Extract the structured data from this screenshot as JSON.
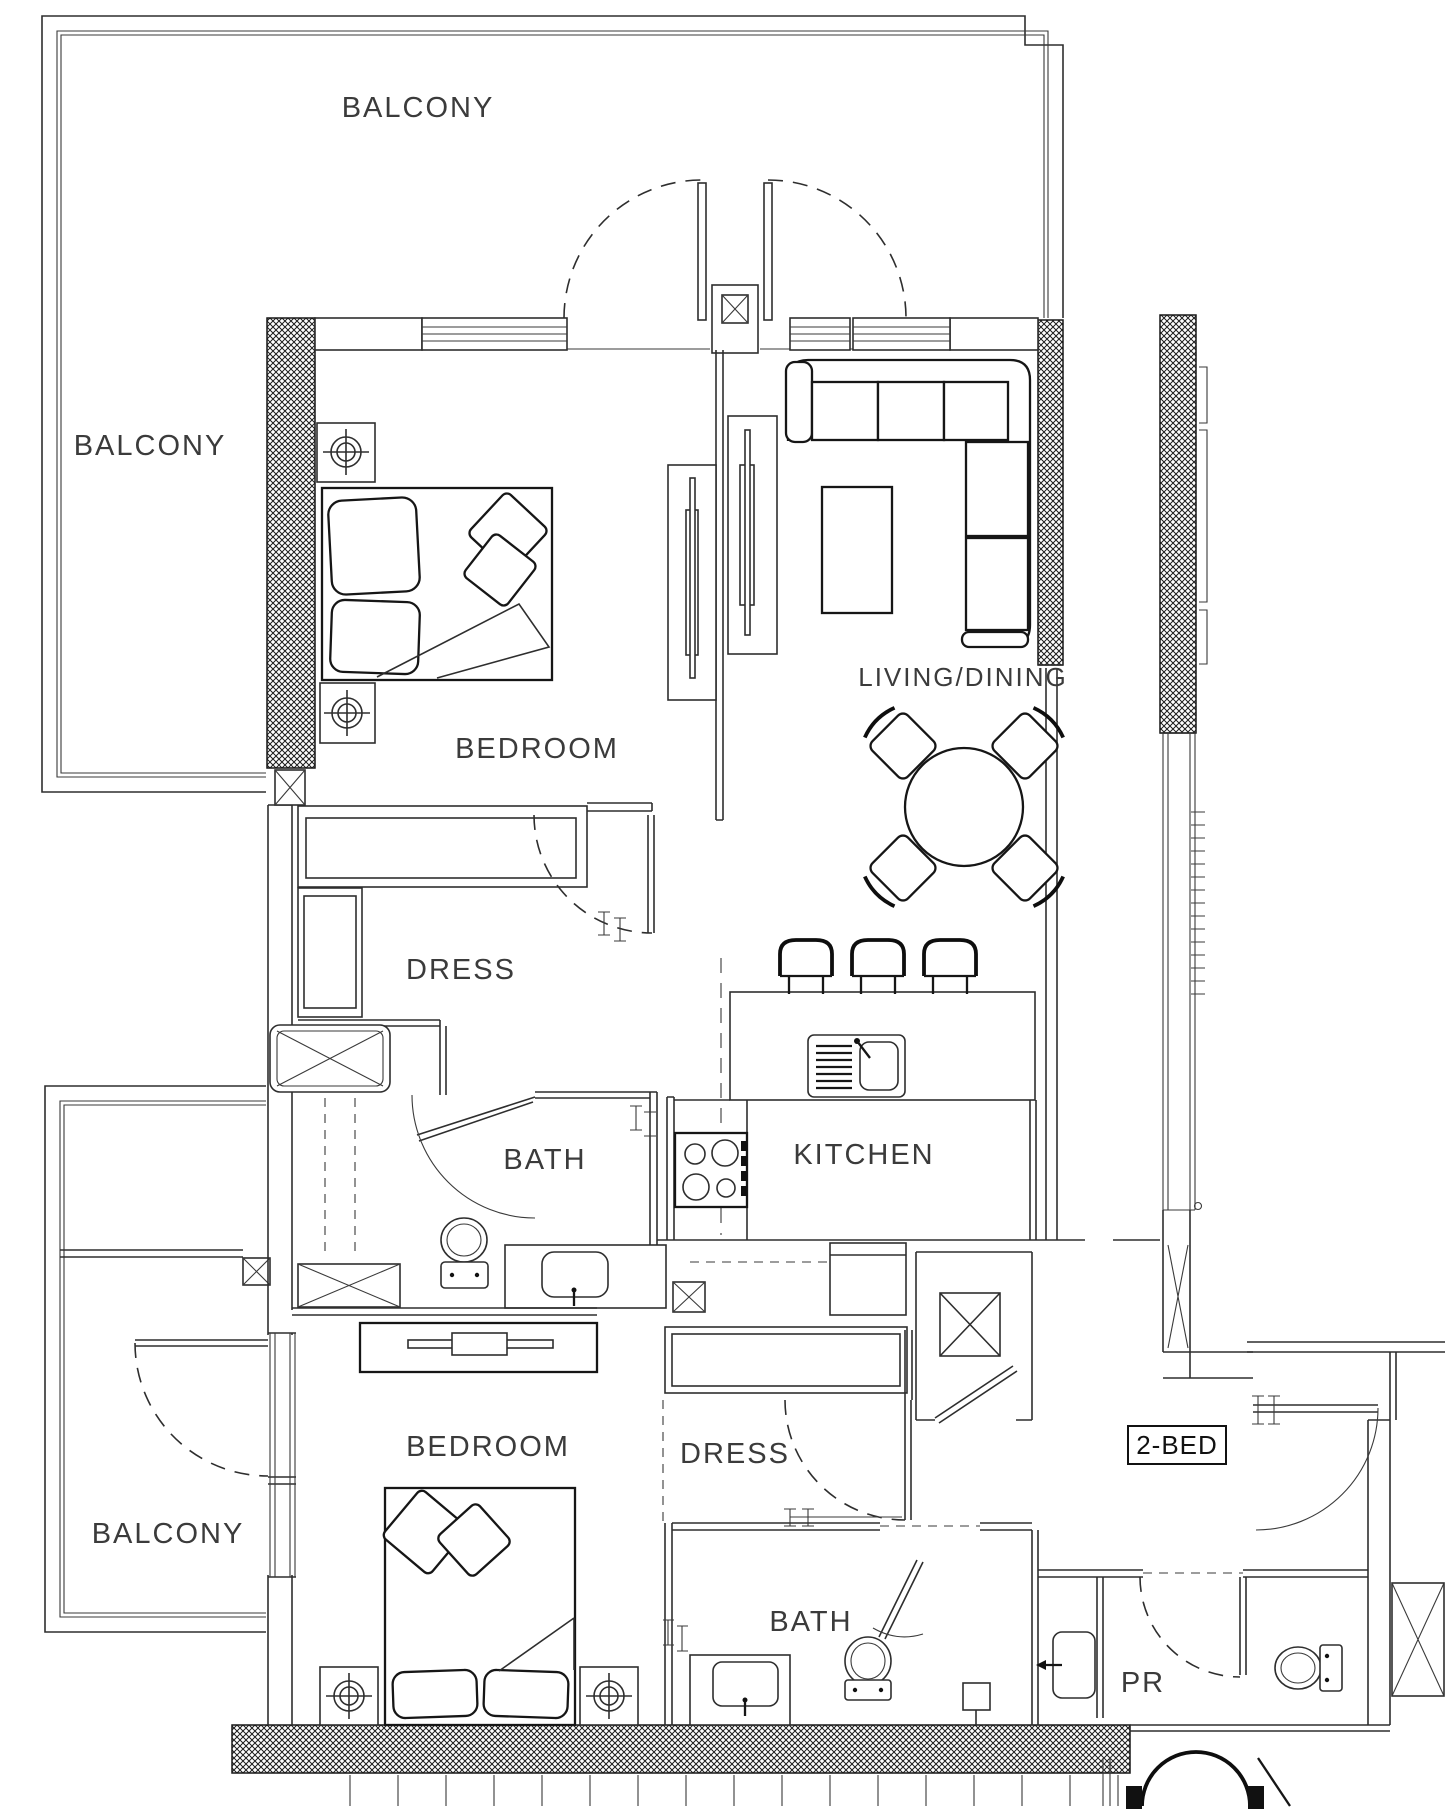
{
  "unit": {
    "type_label": "2-BED"
  },
  "rooms": {
    "balcony_top": "BALCONY",
    "balcony_left": "BALCONY",
    "balcony_bottom": "BALCONY",
    "bedroom_1": "BEDROOM",
    "living_dining": "LIVING/DINING",
    "dress_1": "DRESS",
    "bath_1": "BATH",
    "kitchen": "KITCHEN",
    "bedroom_2": "BEDROOM",
    "dress_2": "DRESS",
    "bath_2": "BATH",
    "powder_room": "PR"
  },
  "colors": {
    "line": "#2e2e2e",
    "wall_hatch": "#161616",
    "background": "#ffffff"
  }
}
